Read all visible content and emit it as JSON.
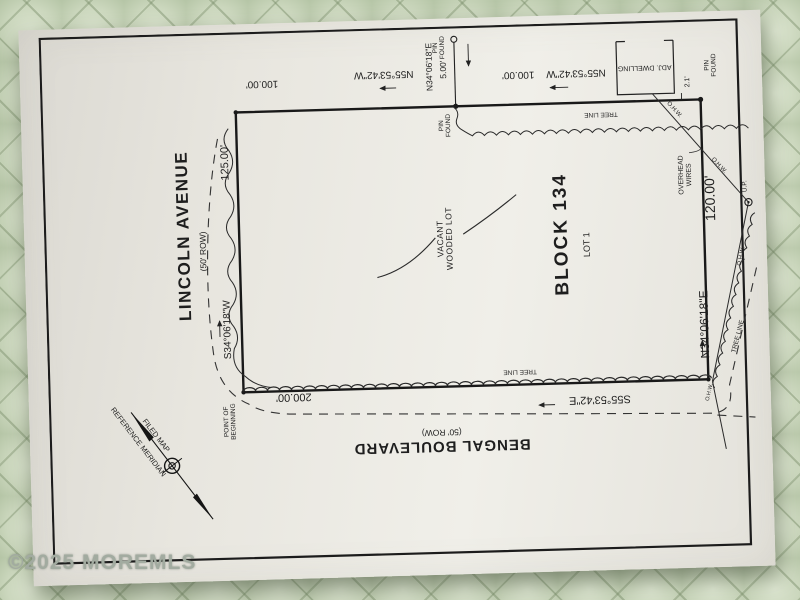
{
  "watermark": "©2025 MOREMLS",
  "streets": {
    "lincoln_name": "LINCOLN AVENUE",
    "lincoln_row": "(50' ROW)",
    "bengal_name": "BENGAL BOULEVARD",
    "bengal_row": "(50' ROW)"
  },
  "parcel": {
    "block": "BLOCK 134",
    "lot": "LOT 1",
    "vacant_line1": "VACANT",
    "vacant_line2": "WOODED LOT"
  },
  "courses": {
    "rear_west": {
      "bearing": "N55°53'42\"W",
      "distance": "100.00'"
    },
    "rear_east": {
      "bearing": "N55°53'42\"W",
      "distance": "100.00'"
    },
    "west": {
      "bearing": "S34°06'18\"W",
      "distance": "125.00'"
    },
    "east": {
      "bearing": "N34°06'18\"E",
      "distance": "120.00'"
    },
    "front": {
      "bearing": "S55°53'42\"E",
      "distance": "200.00'"
    },
    "tie": {
      "bearing": "N34°06'18\"E",
      "distance": "5.00'"
    }
  },
  "annotations": {
    "pin_found_line1": "PIN",
    "pin_found_line2": "FOUND",
    "point_of_beginning_line1": "POINT OF",
    "point_of_beginning_line2": "BEGINNING",
    "tree_line": "TREE LINE",
    "overhead_wires_line1": "OVERHEAD",
    "overhead_wires_line2": "WIRES",
    "ohw": "O.H.W.",
    "utility_pole": "U.P.",
    "adjacent_dwelling": "ADJ. DWELLING",
    "dwelling_offset": "2.1'",
    "reference_meridian": "REFERENCE MERIDIAN",
    "filed_map": "FILED MAP"
  }
}
